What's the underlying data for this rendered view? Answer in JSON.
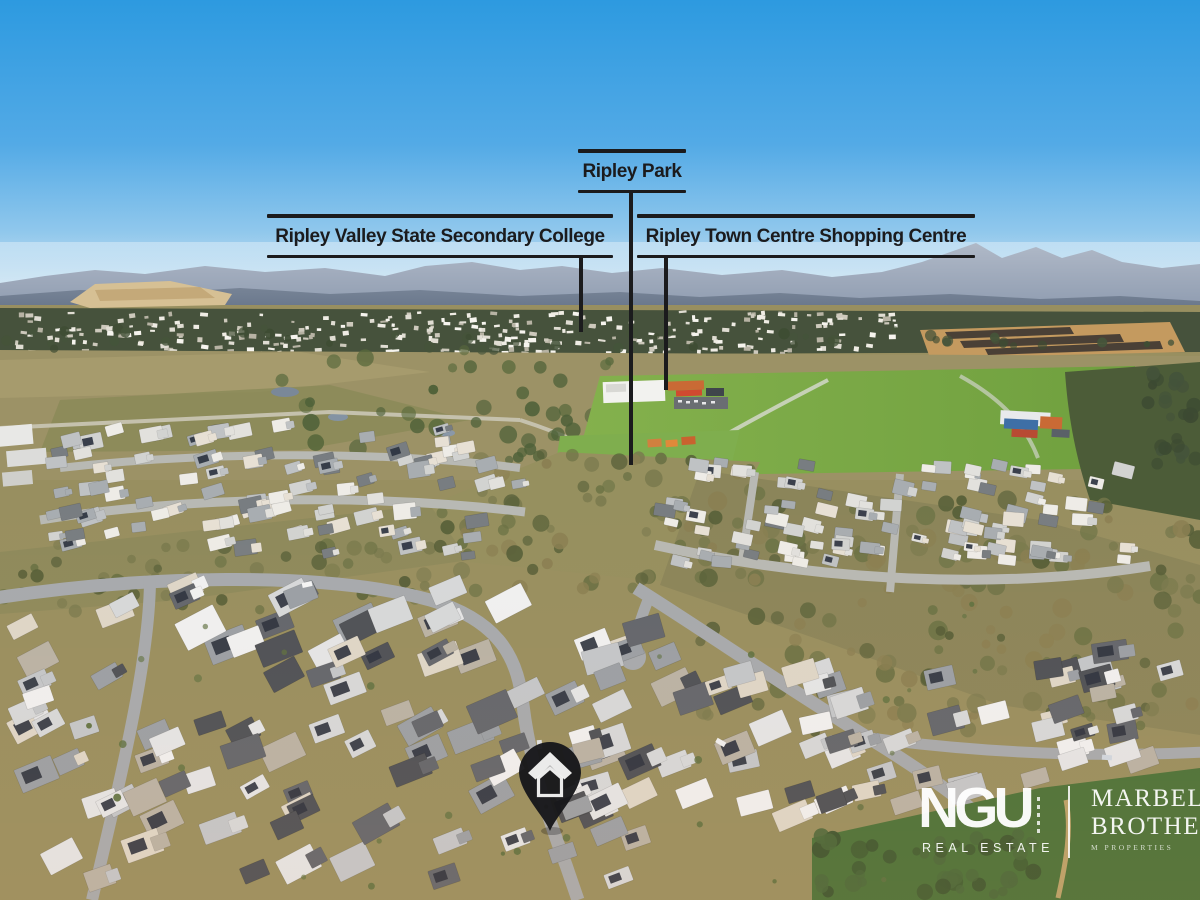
{
  "annotations": {
    "park": {
      "label": "Ripley Park"
    },
    "college": {
      "label": "Ripley Valley State Secondary College"
    },
    "shopping_centre": {
      "label": "Ripley Town Centre Shopping Centre"
    }
  },
  "property_marker": {
    "icon": "house-location-pin-icon",
    "color": "#17171a"
  },
  "branding": {
    "agency_name": "NGU",
    "agency_tagline": "REAL ESTATE",
    "partner_line1": "MARBELLE",
    "partner_line2": "BROTHERS",
    "partner_line3": "M PROPERTIES"
  },
  "colors": {
    "annotation_ink": "#1b1b1d",
    "sky_top": "#2d9ae0",
    "sky_horizon": "#e9f1f6",
    "logo_text": "#ffffff"
  }
}
